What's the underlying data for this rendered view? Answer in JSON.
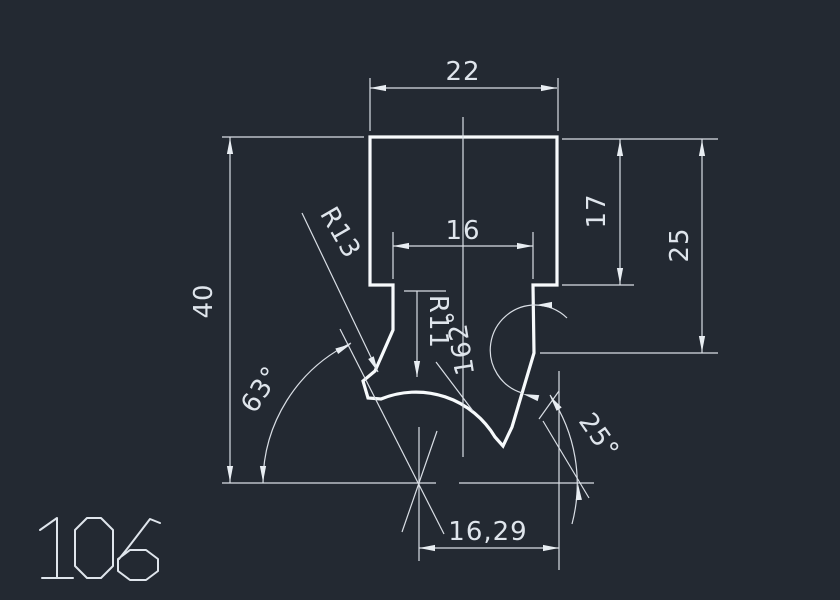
{
  "title": "CAD profile drawing",
  "drawing_number": "106",
  "colors": {
    "background": "#232932",
    "profile_line": "#f7fafc",
    "dimension_line": "#d9dee5",
    "text": "#dfe5ec"
  },
  "labels": {
    "dim_width_top": "22",
    "dim_width_inner": "16",
    "dim_height_upper_right": "17",
    "dim_height_right": "25",
    "dim_height_left": "40",
    "dim_width_bottom": "16,29",
    "radius_outer": "R13",
    "radius_groove": "R11",
    "angle_groove": "162°",
    "angle_left": "63°",
    "angle_right": "25°"
  }
}
